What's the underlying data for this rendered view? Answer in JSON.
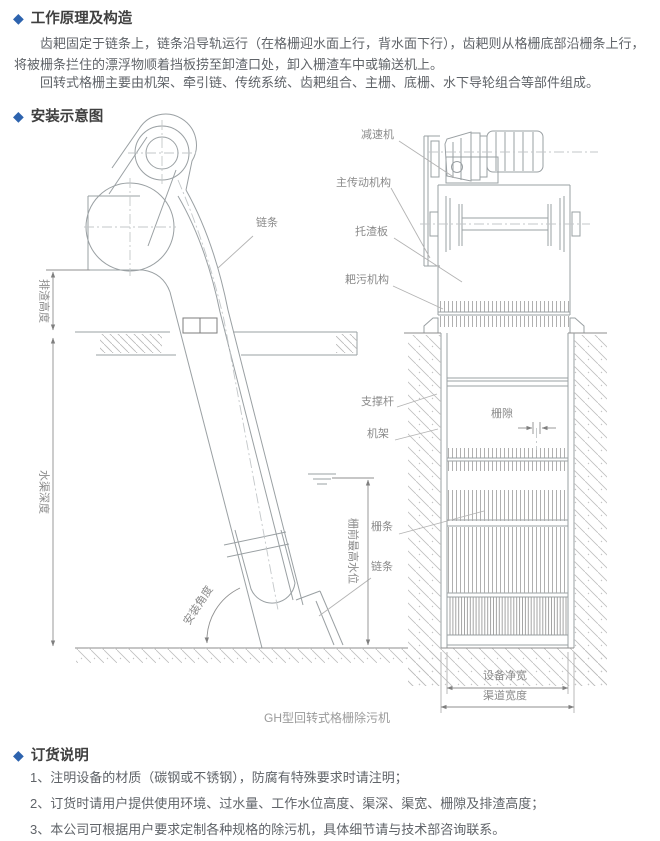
{
  "accent_color": "#2d63ae",
  "working_principle": {
    "title": "工作原理及构造",
    "paragraph1": "齿耙固定于链条上，链条沿导轨运行（在格栅迎水面上行，背水面下行），齿耙则从格栅底部沿栅条上行，将被栅条拦住的漂浮物顺着挡板捞至卸渣口处，卸入栅渣车中或输送机上。",
    "paragraph2": "回转式格栅主要由机架、牵引链、传统系统、齿耙组合、主栅、底栅、水下导轮组合等部件组成。"
  },
  "installation": {
    "title": "安装示意图",
    "caption": "GH型回转式格栅除污机",
    "labels": {
      "chain_top": "链条",
      "discharge_height": "排渣高度",
      "channel_depth": "水渠深度",
      "max_water_level": "栅前最高水位",
      "install_angle": "安装角度",
      "chain_bottom": "链条",
      "support_rod": "支撑杆",
      "frame": "机架",
      "grid_bar": "栅条",
      "reducer": "减速机",
      "main_drive": "主传动机构",
      "slag_plate": "托渣板",
      "rake_mechanism": "耙污机构",
      "grid_gap": "栅隙",
      "equipment_net_width": "设备净宽",
      "channel_width": "渠道宽度"
    }
  },
  "ordering": {
    "title": "订货说明",
    "items": [
      "1、注明设备的材质（碳钢或不锈钢），防腐有特殊要求时请注明；",
      "2、订货时请用户提供使用环境、过水量、工作水位高度、渠深、渠宽、栅隙及排渣高度；",
      "3、本公司可根据用户要求定制各种规格的除污机，具体细节请与技术部咨询联系。"
    ]
  }
}
